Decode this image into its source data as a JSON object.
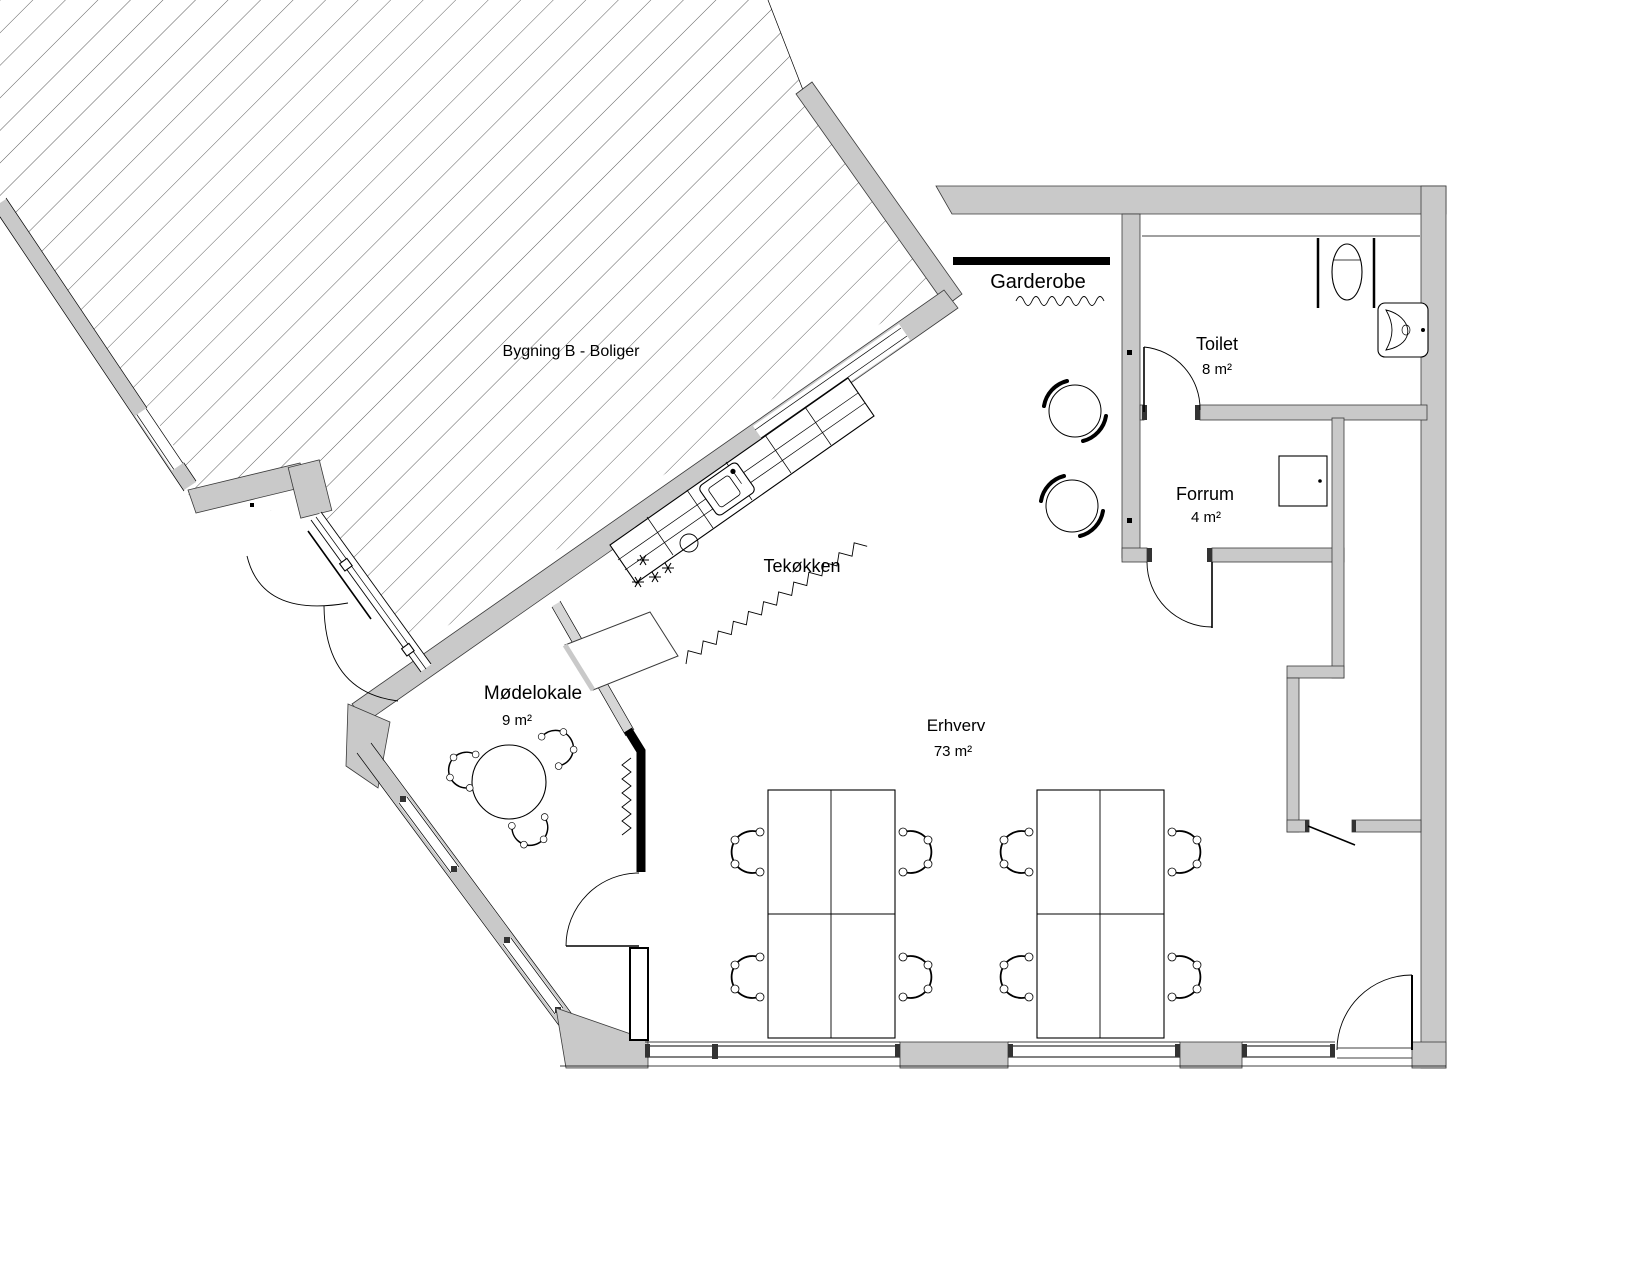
{
  "rooms": {
    "bygning_b": {
      "name": "Bygning B - Boliger"
    },
    "garderobe": {
      "name": "Garderobe"
    },
    "toilet": {
      "name": "Toilet",
      "area": "8 m²"
    },
    "forrum": {
      "name": "Forrum",
      "area": "4 m²"
    },
    "tekokken": {
      "name": "Tekøkken"
    },
    "modelokale": {
      "name": "Mødelokale",
      "area": "9 m²"
    },
    "erhverv": {
      "name": "Erhverv",
      "area": "73 m²"
    }
  },
  "colors": {
    "background": "#ffffff",
    "wall_fill": "#c9c9c9",
    "light_wall_fill": "#d6d6d6",
    "line": "#000000",
    "partition_black": "#000000"
  },
  "icons": {
    "wc_icon": "oval-toilet-bowl",
    "washbasin_icon": "triangular-basin-on-wall",
    "stove_icon": "four-asterisk-burners",
    "kitchen_sink_icon": "rounded-square-sink-with-tap",
    "coat_rail_icon": "solid-black-bar",
    "coat_hooks_icon": "wavy-line",
    "coat_stand_icon": "circle-with-swirl-arcs",
    "accordion_partition_icon": "zigzag-line",
    "door_icon": "quarter-circle-swing",
    "window_icon": "double-parallel-lines",
    "office_chair_icon": "crescent-back-chair",
    "meeting_table_icon": "round-table-three-chairs",
    "desk_group_icon": "two-by-two-desk-cluster"
  }
}
